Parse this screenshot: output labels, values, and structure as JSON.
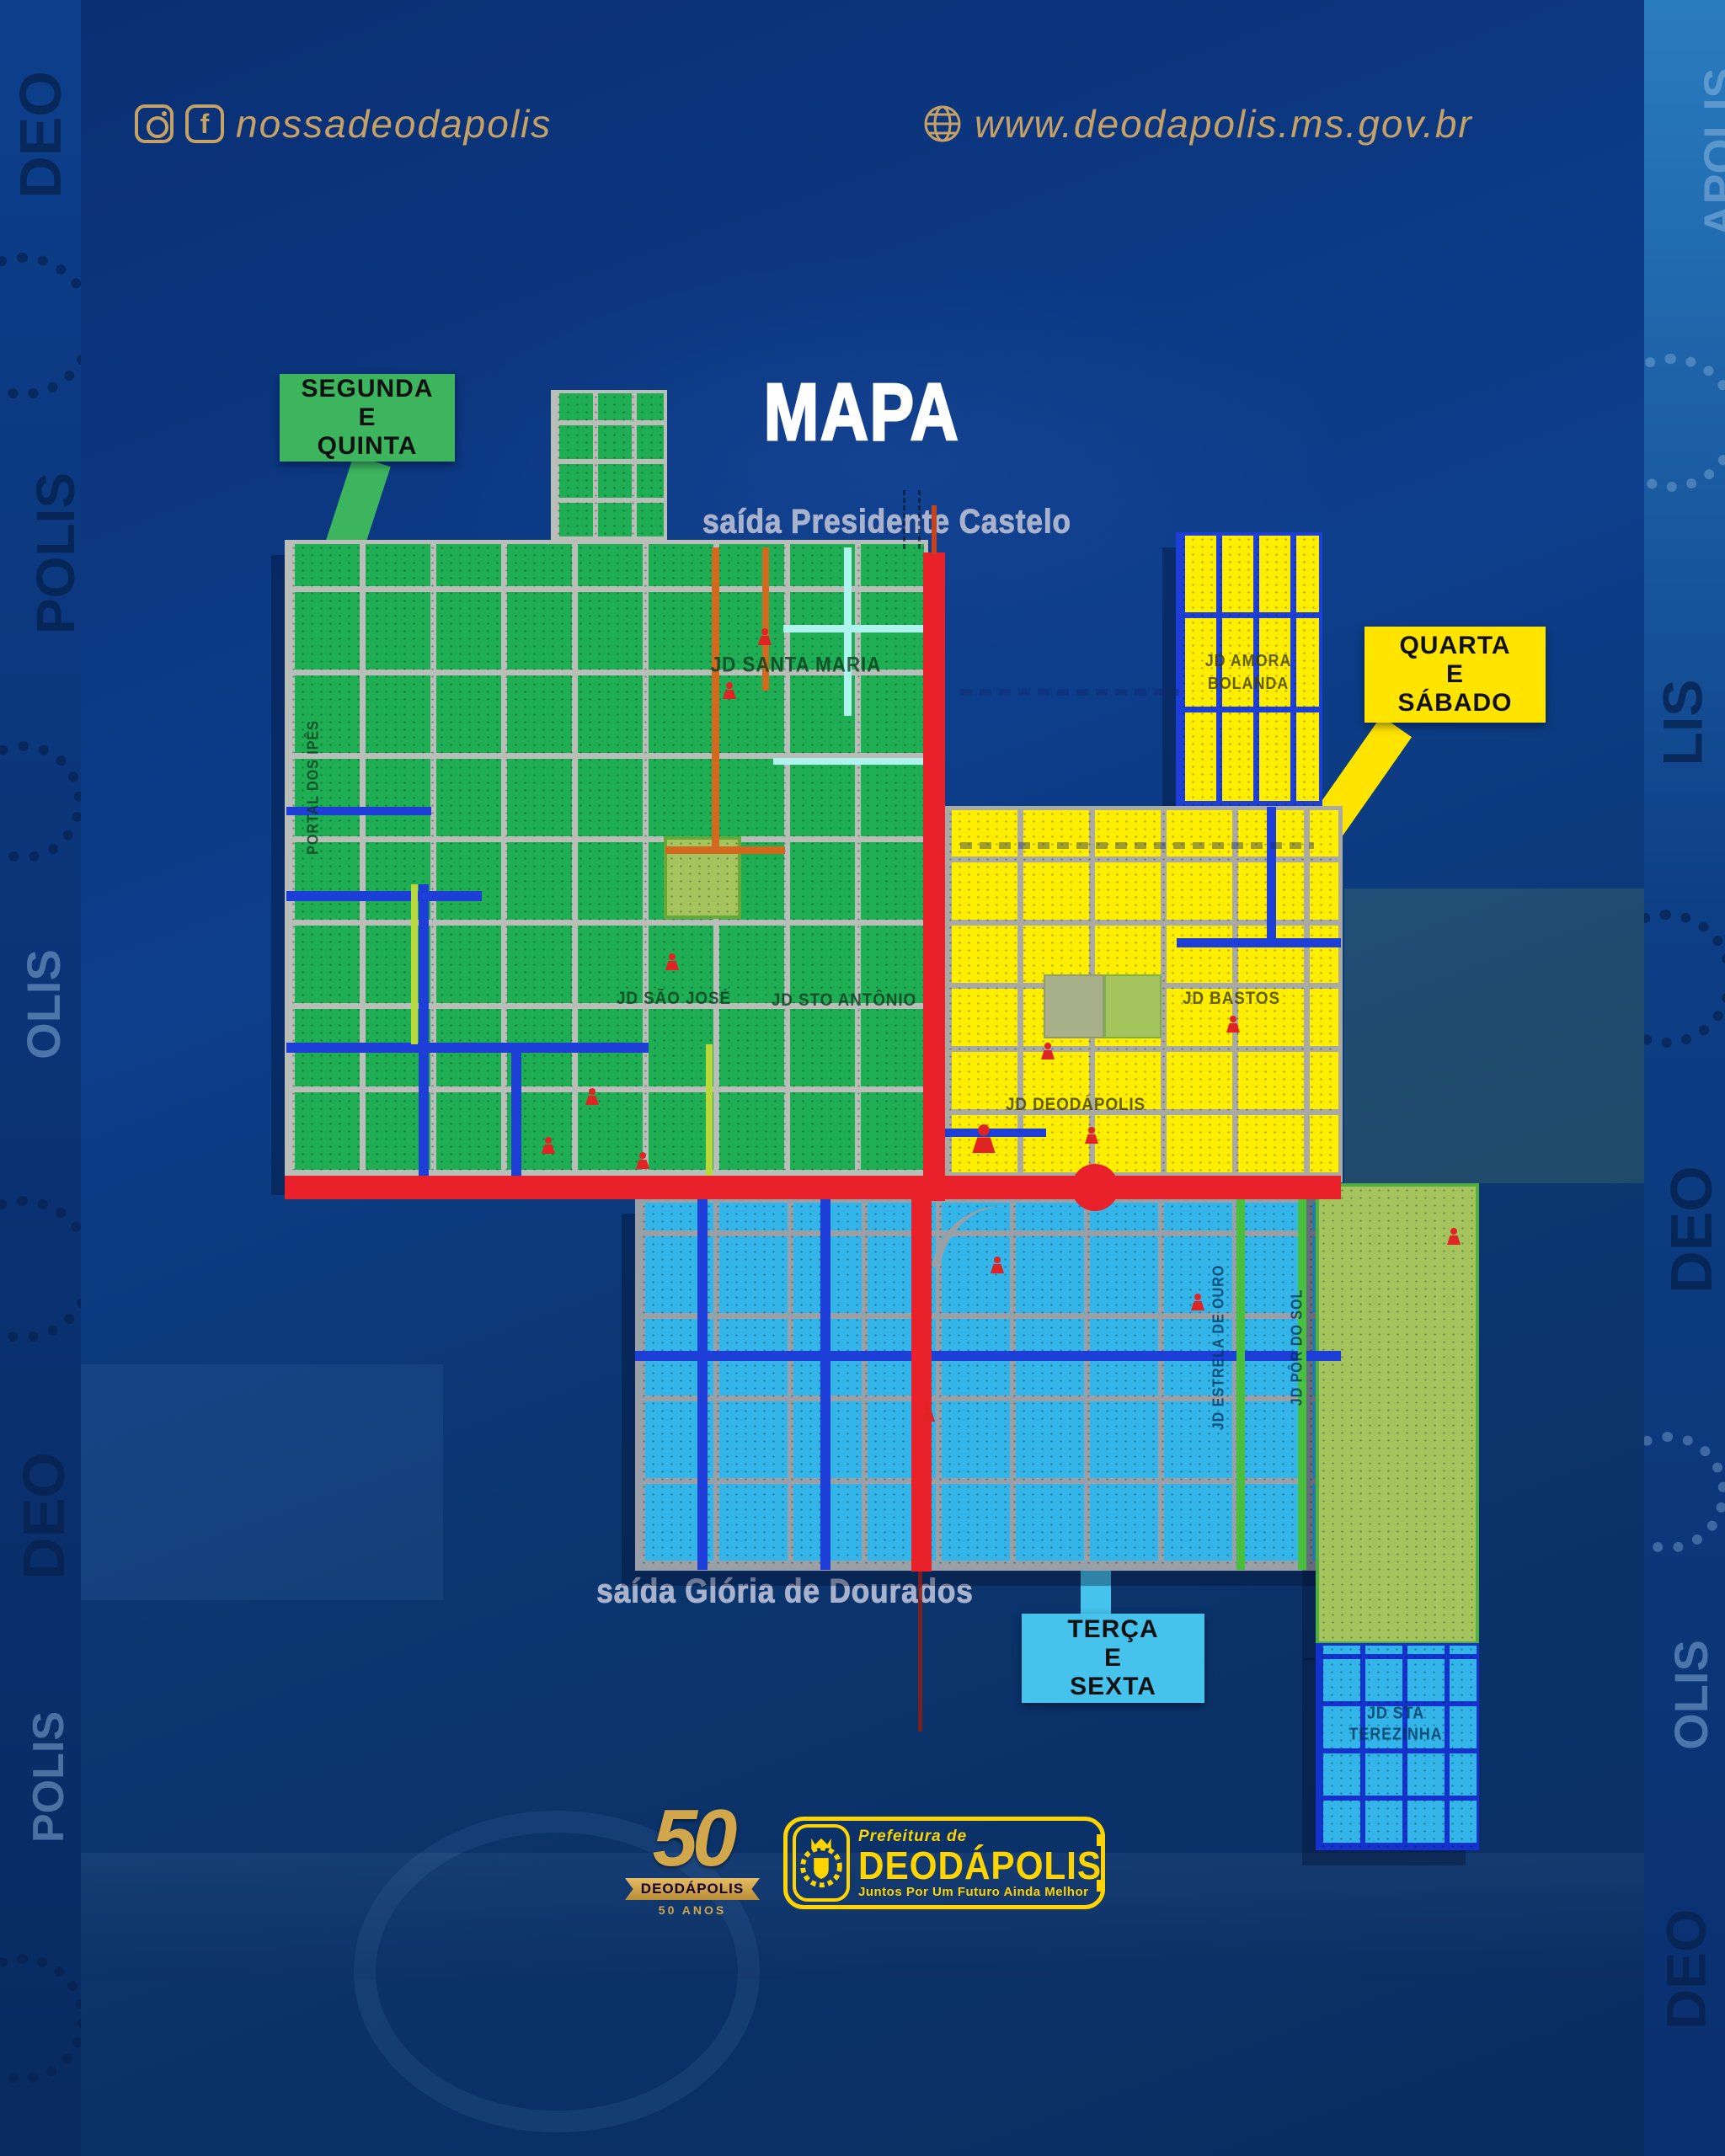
{
  "header": {
    "social_handle": "nossadeodapolis",
    "website": "www.deodapolis.ms.gov.br"
  },
  "title": "MAPA",
  "map": {
    "exit_top": "saída Presidente Castelo",
    "exit_bottom": "saída Glória de Dourados",
    "legend": {
      "green": {
        "line1": "SEGUNDA",
        "line2": "E",
        "line3": "QUINTA"
      },
      "yellow": {
        "line1": "QUARTA",
        "line2": "E",
        "line3": "SÁBADO"
      },
      "blue": {
        "line1": "TERÇA",
        "line2": "E",
        "line3": "SEXTA"
      }
    },
    "districts": {
      "santa_maria": "JD SANTA MARIA",
      "sao_jose": "JD SÃO JOSÉ",
      "sto_antonio": "JD STO ANTÔNIO",
      "portal_ipes": "PORTAL DOS IPÊS",
      "amora_line1": "JD AMORA",
      "amora_line2": "BOLANDA",
      "bastos": "JD BASTOS",
      "deodapolis": "JD DEODÁPOLIS",
      "estrela_ouro": "JD ESTRELA DE OURO",
      "por_do_sol": "JD PÔR DO SOL",
      "terezinha_line1": "JD STA",
      "terezinha_line2": "TEREZINHA"
    },
    "colors": {
      "green_zone": "#1fae54",
      "yellow_zone": "#ffee00",
      "blue_zone": "#33b5e9",
      "road_red": "#e8212a",
      "legend_green": "#3cb55e",
      "legend_yellow": "#ffe400",
      "legend_blue": "#45c3ec"
    }
  },
  "footer": {
    "anniversary": {
      "number": "50",
      "name": "DEODÁPOLIS",
      "years": "50 ANOS"
    },
    "prefeitura": {
      "pre": "Prefeitura de",
      "name": "DEODÁPOLIS",
      "slogan": "Juntos Por Um Futuro Ainda Melhor"
    }
  },
  "decor": {
    "w1": "DEO",
    "w2": "OLIS",
    "w3": "POLIS",
    "w4": "DEO",
    "w5": "LIS",
    "w6": "APOLIS"
  }
}
